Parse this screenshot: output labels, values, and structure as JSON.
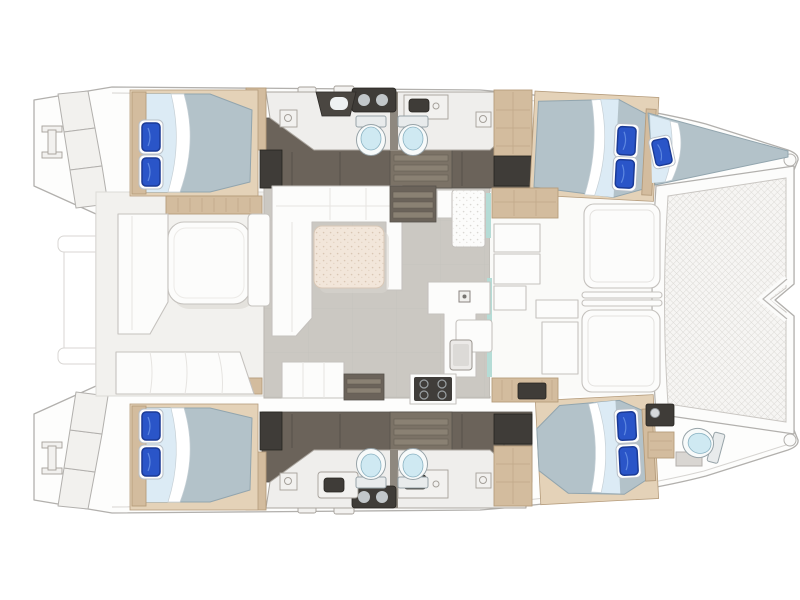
{
  "meta": {
    "title": "Catamaran yacht floor plan, top-down deck and interior layout",
    "view": "top-down",
    "orientation": "bow-right-stern-left"
  },
  "colors": {
    "bg": "#ffffff",
    "deck": "#fdfdfc",
    "hullLine": "#b2b0ad",
    "hullLineSoft": "#d6d4d1",
    "cockpitFloor": "#f2f1ee",
    "saloonFloor": "#cbc8c2",
    "bathFloor": "#efeeec",
    "corridor": "#6b635a",
    "corridorStep": "#7b7266",
    "treadFill": "#8a8173",
    "charcoal": "#3f3c38",
    "wood": "#d3bc9e",
    "woodDark": "#b59c7c",
    "woodLight": "#e4d2b8",
    "mattress": "#b3c2c9",
    "mattressEdge": "#92a5ae",
    "duvet": "#dcebf5",
    "sheetShade": "#c6d0d6",
    "pillow": "#2a55c8",
    "pillowDark": "#1a3a96",
    "pillowShine": "#5d87e0",
    "tableCream": "#f2e6da",
    "tableLine": "#d8c7b6",
    "furn": "#fcfcfb",
    "furnLine": "#c5c2be",
    "toiletLid": "#cfe9f2",
    "toiletLine": "#97a3a8",
    "teal": "#b5dcd6"
  },
  "features": {
    "cabins": [
      {
        "id": "cabin-aft-port",
        "berth": "double",
        "pillows": 2
      },
      {
        "id": "cabin-forward-port",
        "berth": "double",
        "pillows": 2
      },
      {
        "id": "cabin-aft-starboard",
        "berth": "double",
        "pillows": 2
      },
      {
        "id": "cabin-forward-starboard",
        "berth": "double",
        "pillows": 2
      },
      {
        "id": "berth-forepeak-port",
        "berth": "single",
        "pillows": 1
      }
    ],
    "heads": [
      {
        "id": "head-port-aft",
        "toilets": 1
      },
      {
        "id": "head-port-forward",
        "toilets": 1
      },
      {
        "id": "head-starboard-aft",
        "toilets": 1
      },
      {
        "id": "head-starboard-forward",
        "toilets": 1
      },
      {
        "id": "head-forepeak-starboard",
        "toilets": 1
      }
    ],
    "areas": [
      "bow-trampoline",
      "forward-cockpit-sun-seats",
      "saloon-u-sofa-and-table",
      "galley-with-stove-and-sink",
      "aft-cockpit-table-and-benches",
      "transom-steps-port",
      "transom-steps-starboard",
      "dinghy-davits"
    ],
    "counts": {
      "double_berths": 4,
      "single_berths": 1,
      "toilets": 5,
      "stove_burners": 4,
      "cockpit_tables": 2
    }
  }
}
